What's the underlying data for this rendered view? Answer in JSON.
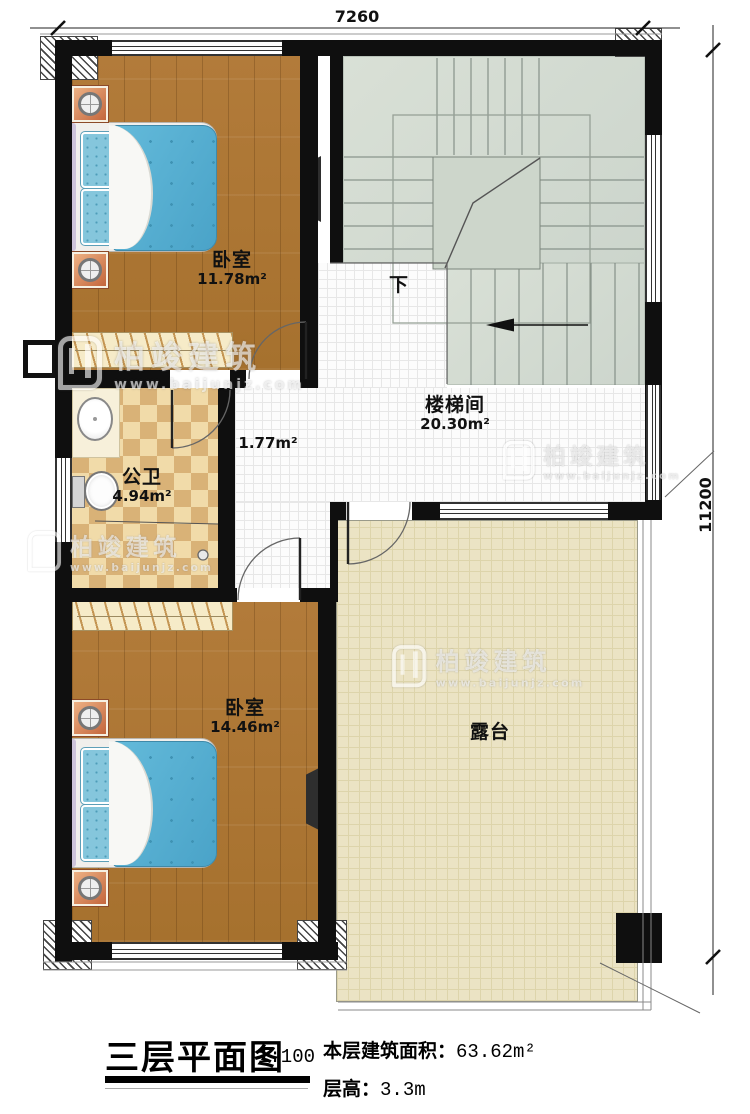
{
  "plan": {
    "dim_top": "7260",
    "dim_right": "11200",
    "rooms": {
      "bedroom1": {
        "name": "卧室",
        "area": "11.78m²"
      },
      "stairwell": {
        "name": "楼梯间",
        "area": "20.30m²"
      },
      "hallway": {
        "area": "1.77m²"
      },
      "bathroom": {
        "name": "公卫",
        "area": "4.94m²"
      },
      "bedroom2": {
        "name": "卧室",
        "area": "14.46m²"
      },
      "terrace": {
        "name": "露台"
      }
    },
    "stairs": {
      "down_label": "下"
    }
  },
  "title_block": {
    "title": "三层平面图",
    "scale": "1:100",
    "floor_area_label": "本层建筑面积：",
    "floor_area_value": "63.62m²",
    "floor_height_label": "层高：",
    "floor_height_value": "3.3m"
  },
  "watermark": {
    "brand": "柏竣建筑",
    "url": "www.baijunjz.com"
  },
  "colors": {
    "wall": "#0f0f0f",
    "wood": "#ac7433",
    "tile_light": "#f1dba9",
    "tile_dark": "#d9b277",
    "stair_floor": "#d5dcd2",
    "terrace_floor": "#ebe3c4",
    "bed_quilt": "#57b2d6",
    "nightstand": "#d98d5f"
  }
}
